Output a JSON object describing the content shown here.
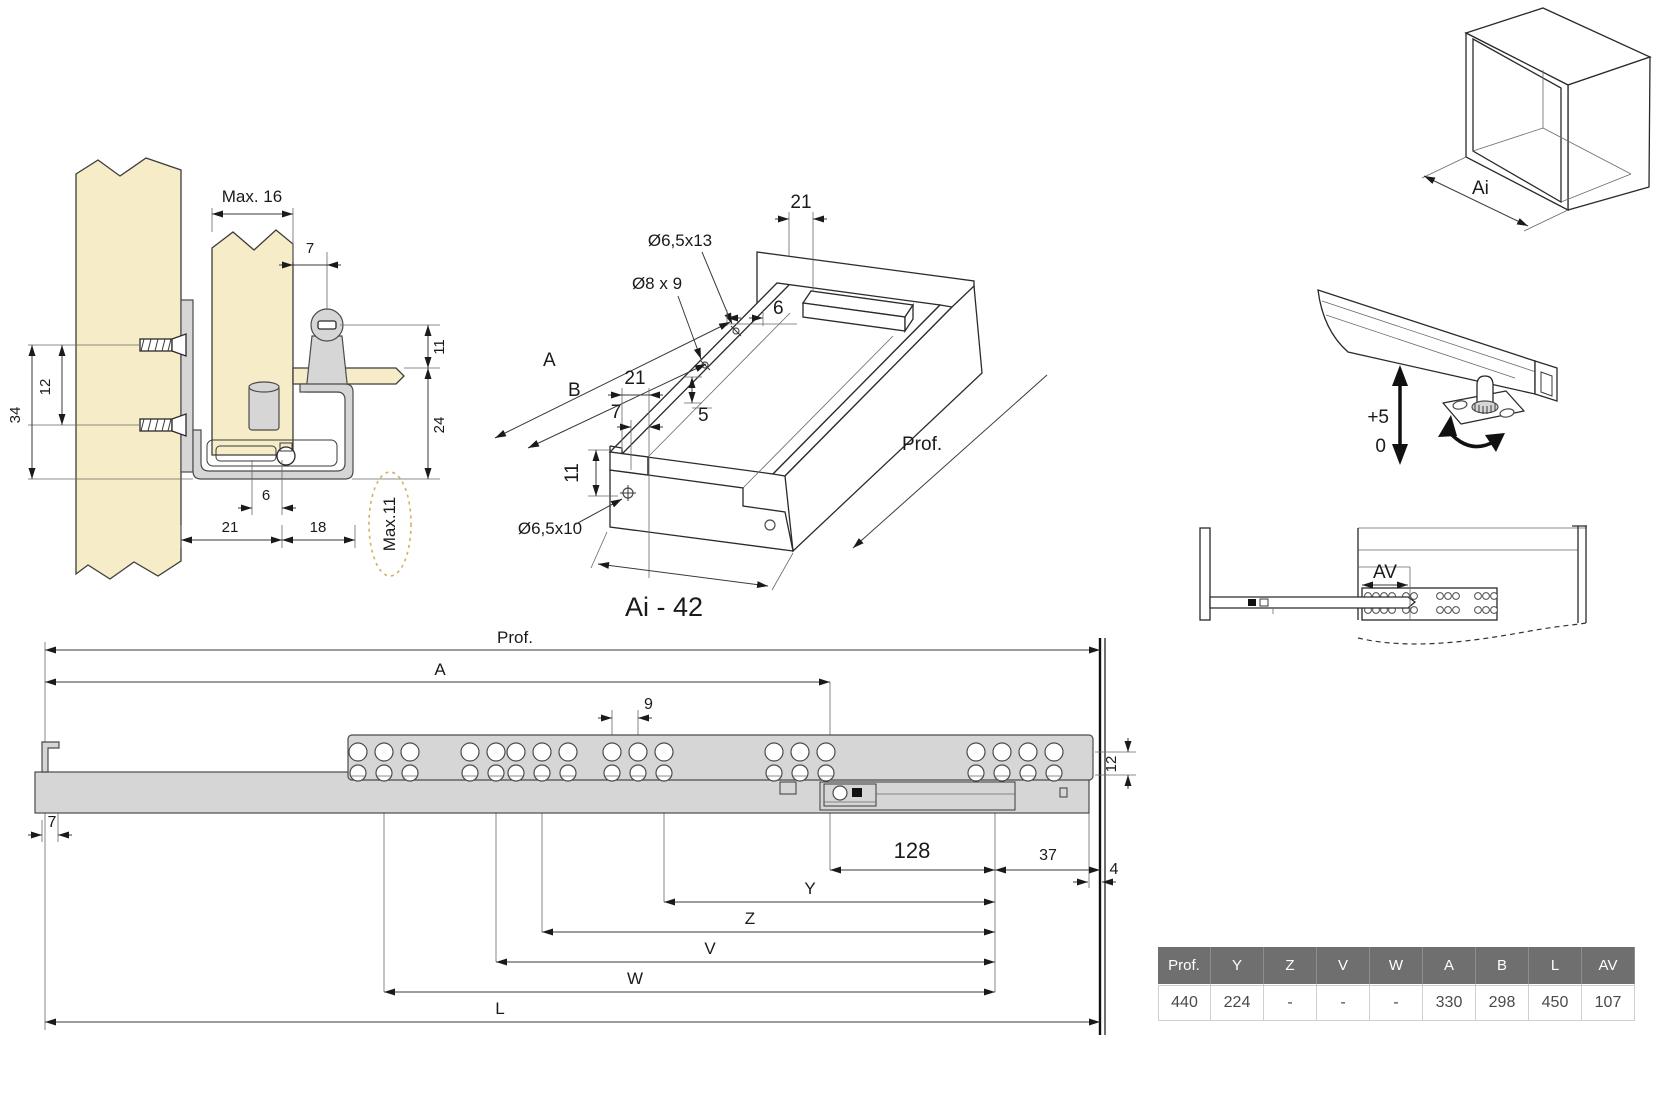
{
  "colors": {
    "wood": "#f6ecc7",
    "metal": "#d6d6d6",
    "line": "#2a2a2a",
    "dashed_highlight": "#d4b163",
    "table_header_bg": "#6f6f6f",
    "table_header_text": "#ffffff",
    "table_value_text": "#4a4a4a"
  },
  "cross_section": {
    "max_top": "Max. 16",
    "dim7": "7",
    "dim12": "12",
    "dim34": "34",
    "dim11": "11",
    "dim24": "24",
    "dim6": "6",
    "dim21": "21",
    "dim18": "18",
    "max_side": "Max.11"
  },
  "iso_view": {
    "dim21_top": "21",
    "drill_top": "Ø6,5x13",
    "drill_mid": "Ø8 x 9",
    "dim6": "6",
    "dim_a": "A",
    "dim_b": "B",
    "dim21": "21",
    "dim7": "7",
    "dim5": "5",
    "dim11": "11",
    "drill_front": "Ø6,5x10",
    "prof": "Prof.",
    "width_note": "Ai - 42"
  },
  "cabinet_view": {
    "ai": "Ai"
  },
  "bracket_view": {
    "plus": "+5",
    "zero": "0"
  },
  "extension_view": {
    "av": "AV"
  },
  "side_view": {
    "prof": "Prof.",
    "dim_a": "A",
    "dim9": "9",
    "dim12": "12",
    "dim7": "7",
    "dim4": "4",
    "dim128": "128",
    "dim37": "37",
    "dim_y": "Y",
    "dim_z": "Z",
    "dim_v": "V",
    "dim_w": "W",
    "dim_l": "L"
  },
  "spec_table": {
    "headers": [
      "Prof.",
      "Y",
      "Z",
      "V",
      "W",
      "A",
      "B",
      "L",
      "AV"
    ],
    "row": [
      "440",
      "224",
      "-",
      "-",
      "-",
      "330",
      "298",
      "450",
      "107"
    ]
  }
}
